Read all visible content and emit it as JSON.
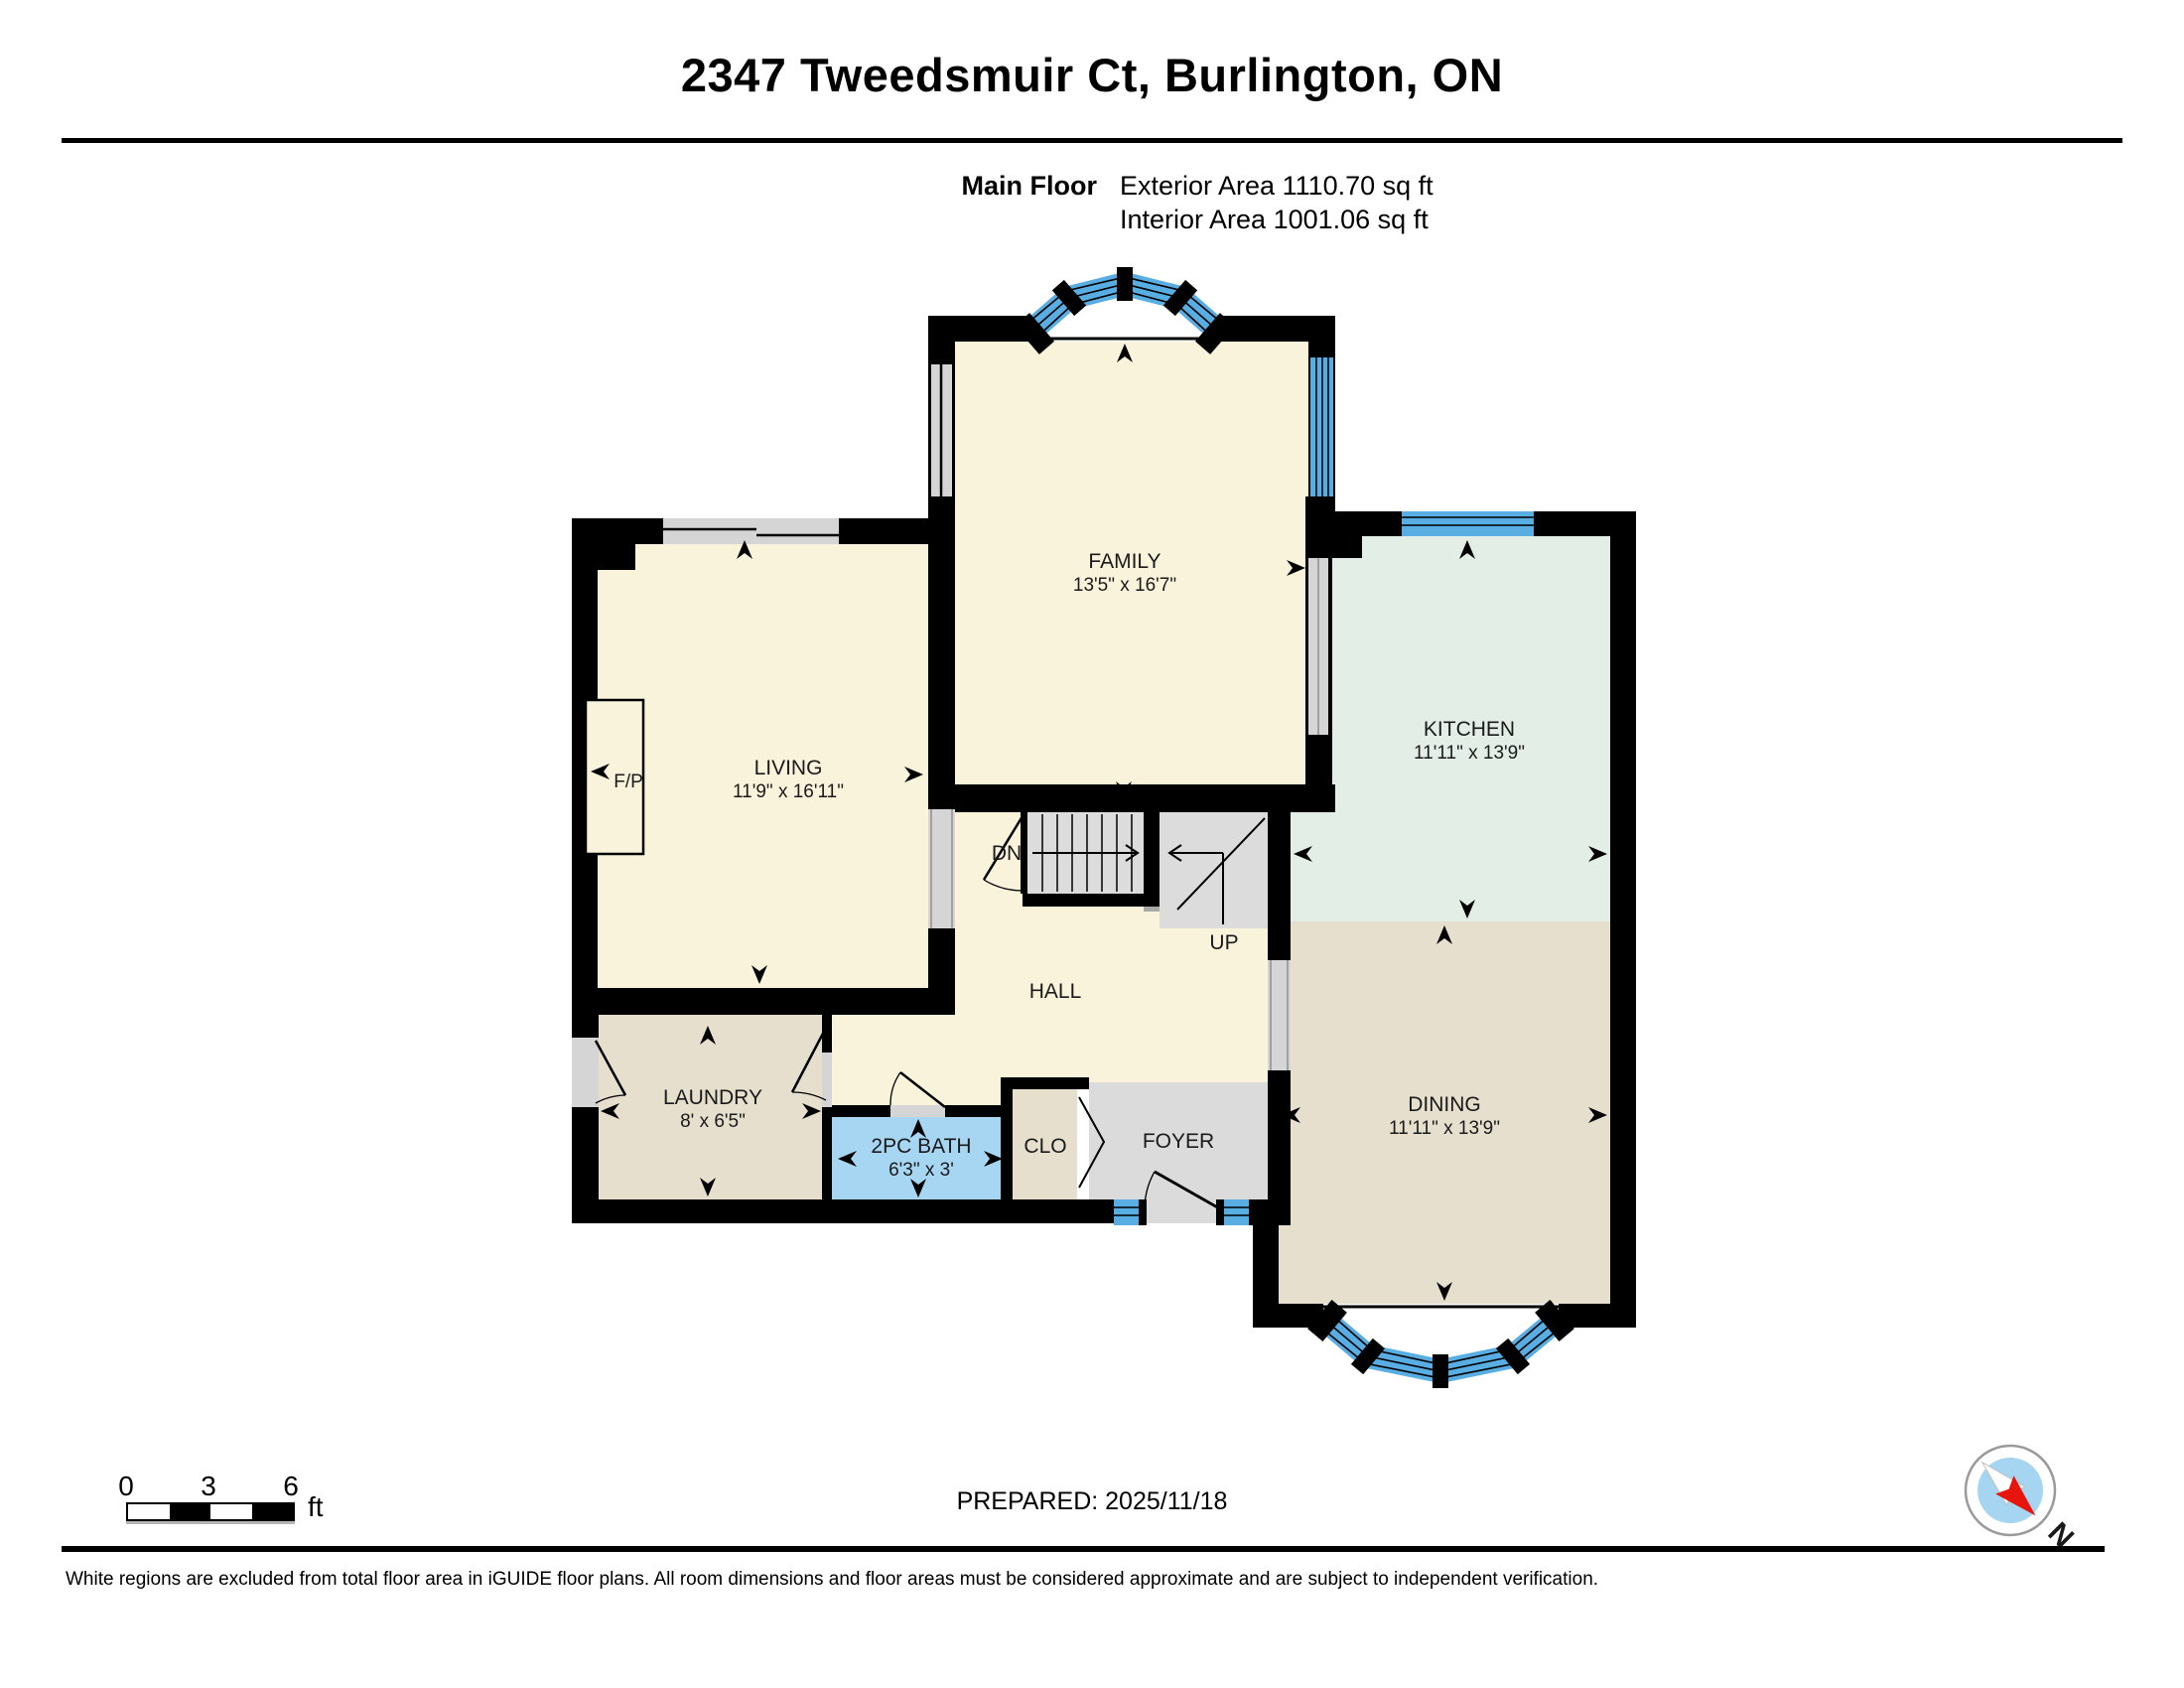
{
  "header": {
    "title": "2347 Tweedsmuir Ct, Burlington, ON",
    "floor_label": "Main Floor",
    "exterior_area": "Exterior Area 1110.70 sq ft",
    "interior_area": "Interior Area 1001.06 sq ft"
  },
  "rooms": [
    {
      "name": "FAMILY",
      "dims": "13'5\" x 16'7\""
    },
    {
      "name": "LIVING",
      "dims": "11'9\" x 16'11\""
    },
    {
      "name": "KITCHEN",
      "dims": "11'11\" x 13'9\""
    },
    {
      "name": "DINING",
      "dims": "11'11\" x 13'9\""
    },
    {
      "name": "LAUNDRY",
      "dims": "8' x 6'5\""
    },
    {
      "name": "2PC BATH",
      "dims": "6'3\" x 3'"
    },
    {
      "name": "CLO",
      "dims": ""
    },
    {
      "name": "FOYER",
      "dims": ""
    },
    {
      "name": "HALL",
      "dims": ""
    }
  ],
  "plan_labels": {
    "fireplace": "F/P",
    "stairs_down": "DN",
    "stairs_up": "UP"
  },
  "scale_bar": {
    "ticks": [
      "0",
      "3",
      "6"
    ],
    "unit": "ft"
  },
  "footer": {
    "prepared": "PREPARED: 2025/11/18",
    "compass_north": "N",
    "disclaimer": "White regions are excluded from total floor area in iGUIDE floor plans. All room dimensions and floor areas must be considered approximate and are subject to independent verification."
  },
  "colors": {
    "wall": "#000000",
    "room_cream": "#FAF3DC",
    "room_mint": "#E3EFE6",
    "room_tan": "#E6DFCE",
    "bath_blue": "#A6D6F2",
    "floor_gray": "#DBDBDB",
    "stair_gray": "#DCDCDC",
    "window_blue": "#58ADE2",
    "opening_gray": "#D5D5D5",
    "compass_blue": "#A5D5F0",
    "compass_red": "#E8150D"
  }
}
